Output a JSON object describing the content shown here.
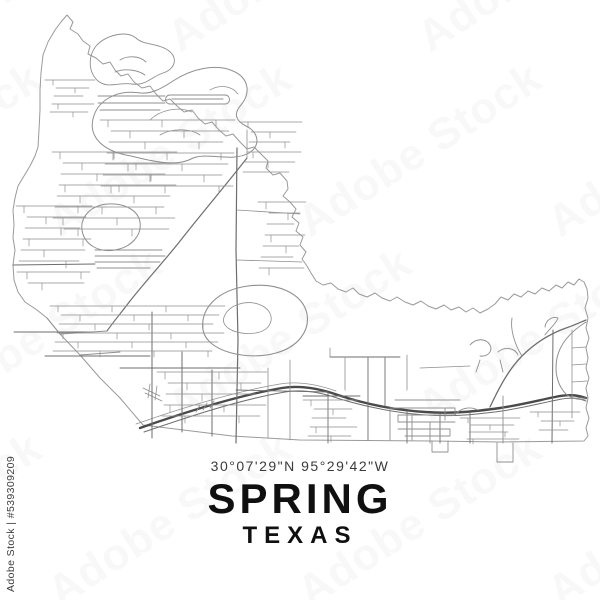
{
  "image": {
    "watermark_text": "Adobe Stock",
    "stock_id_label": "Adobe Stock | #539309209"
  },
  "title_block": {
    "coordinates": "30°07'29\"N 95°29'42\"W",
    "city": "SPRING",
    "state": "TEXAS",
    "text_color": "#101010",
    "coord_color": "#3b3b3b"
  },
  "map": {
    "background": "#ffffff",
    "boundary_color": "#9a9a9a",
    "minor_color": "#8f8f8f",
    "major_color": "#6e6e6e",
    "highway_color": "#4a4a4a",
    "paths": [
      {
        "d": "M67,15 L73,22 70,29 78,34 83,41 90,46 88,54 96,58 103,64 110,62 115,70 121,76 128,74 134,82 142,88 150,86 156,94 163,101 170,99 177,106 184,112 192,110 198,118 205,124 212,122 219,130 226,136 233,134 240,142 247,149 254,147 261,154 268,161 266,168 273,175 280,173 287,181 288,189 283,196 290,202 296,209 292,217 299,223 296,231 303,237 300,245 306,252 302,259 307,266 311,273 316,281 323,285 331,283 338,289 346,292 353,288 359,294 367,297 375,293 382,298 390,301 397,297 405,302 413,305 421,301 428,306 436,309 444,305 451,310 459,307 466,312 473,308 480,313 488,309 495,304 501,297 508,300 514,294 521,297 528,291 535,294 542,288 549,291 556,285 562,288 568,282 574,285 579,279 584,282 587,289 588,298 585,308 588,318 586,328 589,338 586,348 588,358 586,368 589,378 586,388 588,398 586,408 589,418 586,428 588,436 584,441 L500,442 432,441 300,440 232,436 143,425 120,398 100,378 80,355 60,334 47,318 37,310 25,302 18,292 14,280 13,265 15,250 13,238 14,225 13,210 15,198 18,186 24,176 30,166 35,156 38,147 39,130 40,110 40,90 41,73 43,55 48,42 55,30 61,22 Z",
        "w": 1,
        "c": "#9a9a9a"
      },
      {
        "d": "M140,428 C180,414 235,396 282,388 C300,385 318,388 338,395 C365,404 395,410 425,412 C455,414 478,411 500,408 C520,405 540,400 555,397 C568,394 577,395 586,398",
        "w": 2.4,
        "c": "#4a4a4a"
      },
      {
        "d": "M144,432 C185,418 238,400 285,392 C302,389 320,392 340,399 C367,407 396,413 426,415 C456,417 480,414 502,411 C522,408 542,403 557,400 C569,397 578,398 586,401",
        "w": 1,
        "c": "#6e6e6e"
      },
      {
        "d": "M136,424 C176,410 232,392 280,384 C298,381 316,384 336,391",
        "w": 0.8,
        "c": "#8f8f8f"
      },
      {
        "d": "M143,388 L160,396 M145,393 L162,401 M150,384 L148,398 M157,386 L155,400 M200,405 L196,412 M207,403 L203,410 M214,401 L210,408",
        "w": 0.8,
        "c": "#8f8f8f"
      },
      {
        "d": "M490,407 C498,390 508,370 522,356 C536,342 552,333 566,328 C575,325 581,322 586,320",
        "w": 1.3,
        "c": "#6e6e6e"
      },
      {
        "d": "M522,356 C515,345 510,330 512,318 M545,335 C550,328 556,324 558,318 C552,316 546,320 545,327",
        "w": 0.9,
        "c": "#8f8f8f"
      },
      {
        "d": "M586,322 C570,332 560,344 557,358 C554,373 558,386 566,394 C572,399 580,400 585,399",
        "w": 1,
        "c": "#8f8f8f"
      },
      {
        "d": "M572,330 L572,418 M572,348 L586,347 M572,365 L586,364 M572,382 L587,381 M572,398 L586,398",
        "w": 0.8,
        "c": "#8f8f8f"
      },
      {
        "d": "M553,330 L552,443",
        "w": 1,
        "c": "#6e6e6e"
      },
      {
        "d": "M237,148 L236,250 238,340 236,443",
        "w": 1.2,
        "c": "#6e6e6e"
      },
      {
        "d": "M152,312 L152,438 M182,352 L182,432 M212,370 L212,436",
        "w": 1,
        "c": "#6e6e6e"
      },
      {
        "d": "M268,368 L268,438 M290,360 L290,440",
        "w": 0.8,
        "c": "#8f8f8f"
      },
      {
        "d": "M328,392 L328,443 M368,358 L368,440 M385,358 L385,406 M407,412 L407,443 M440,414 L440,443 M470,413 L470,443",
        "w": 0.9,
        "c": "#6e6e6e"
      },
      {
        "d": "M503,396 L503,443 M497,443 L497,462 513,462 513,443 M432,441 L432,452 448,452 448,441",
        "w": 0.9,
        "c": "#8f8f8f"
      },
      {
        "d": "M45,356 L150,356 M14,332 L90,332 M13,265 L95,264 M120,368 L240,368 M330,357 L400,357 M236,390 L328,392 M303,396 L360,396",
        "w": 0.9,
        "c": "#6e6e6e"
      },
      {
        "d": "M247,158 C225,186 203,212 184,236 C168,257 149,277 130,301 C121,313 114,321 107,331",
        "w": 1.2,
        "c": "#6e6e6e"
      },
      {
        "d": "M237,210 L300,214 M237,260 L302,262 M247,158 L247,130",
        "w": 0.8,
        "c": "#8f8f8f"
      },
      {
        "d": "M98,96 L165,96 M98,103 L165,103 M100,110 L160,110 M170,95 L225,95 C231,95 231,104 225,104 L170,104 C164,104 164,95 170,95 Z M172,99 L223,99",
        "w": 0.9,
        "c": "#8f8f8f"
      },
      {
        "d": "M95,250 L162,250 M95,256 L165,256 M95,262 L160,262 M97,268 L150,268",
        "w": 0.9,
        "c": "#8f8f8f"
      },
      {
        "d": "M82,230 C80,216 92,205 108,204 C124,203 138,210 140,222 C142,235 132,247 115,250 C98,253 84,244 82,230 Z",
        "w": 1,
        "c": "#8f8f8f"
      },
      {
        "d": "M203,330 C200,308 218,290 248,286 C278,282 303,294 307,314 C310,331 298,347 276,353 C248,361 207,352 203,330 Z",
        "w": 1.1,
        "c": "#8f8f8f"
      },
      {
        "d": "M225,315 C230,305 245,300 258,304 C270,308 275,318 268,327 C260,336 238,335 228,328 C223,324 222,320 225,315 Z",
        "w": 0.8,
        "c": "#8f8f8f"
      },
      {
        "d": "M96,46 C106,35 126,30 136,38 C143,45 156,43 166,49 C179,56 176,69 163,73 C151,77 146,86 132,84 C118,82 108,89 98,81 C88,72 88,56 96,46 Z M120,60 C128,55 140,56 146,62 M115,72 C125,68 138,70 145,75",
        "w": 0.9,
        "c": "#8f8f8f"
      },
      {
        "d": "M131,156 C101,151 89,136 93,119 C97,101 116,89 141,93 C151,94 161,89 173,81 C191,69 216,63 233,71 C249,78 251,93 241,105 C233,114 236,121 246,126 C259,132 261,146 249,153 C231,163 206,151 191,159 C176,167 151,161 131,156 Z",
        "w": 1,
        "c": "#8f8f8f"
      },
      {
        "d": "M150,120 C160,110 178,106 192,112 M160,135 C172,128 190,128 200,135 M210,90 C220,84 232,86 238,94",
        "w": 0.8,
        "c": "#8f8f8f"
      },
      {
        "d": "M470,345 C476,338 486,338 490,345 C493,351 488,357 480,356 M498,352 C505,346 515,348 518,355 M480,360 L476,372 M500,360 L503,372 M455,415 C460,408 470,406 478,410",
        "w": 0.9,
        "c": "#8f8f8f"
      },
      {
        "d": "M390,408 L455,408 455,415 398,415 398,422 455,422 M390,408 L390,440 M398,429 L450,429 450,436 405,436 M412,415 L412,440 M430,422 L430,443 M445,408 L445,420 M395,400 L460,400",
        "w": 0.9,
        "c": "#8f8f8f"
      },
      {
        "d": "M330,348 L330,357 M345,357 L345,390 M407,355 L407,390 M420,368 L470,366",
        "w": 0.8,
        "c": "#8f8f8f"
      },
      {
        "d": "M60,334 L107,331 M47,318 L60,334 M80,355 L120,352",
        "w": 0.9,
        "c": "#8f8f8f"
      }
    ],
    "street_clusters": [
      {
        "x": 100,
        "y": 120,
        "w": 135,
        "h": 68,
        "gap": 11,
        "tooth": 7
      },
      {
        "x": 52,
        "y": 152,
        "w": 125,
        "h": 80,
        "gap": 11,
        "tooth": 7
      },
      {
        "x": 240,
        "y": 122,
        "w": 62,
        "h": 56,
        "gap": 10,
        "tooth": 6
      },
      {
        "x": 16,
        "y": 206,
        "w": 76,
        "h": 80,
        "gap": 11,
        "tooth": 7
      },
      {
        "x": 50,
        "y": 306,
        "w": 175,
        "h": 46,
        "gap": 9,
        "tooth": 6
      },
      {
        "x": 157,
        "y": 372,
        "w": 110,
        "h": 52,
        "gap": 11,
        "tooth": 7
      },
      {
        "x": 303,
        "y": 400,
        "w": 55,
        "h": 38,
        "gap": 9,
        "tooth": 6
      },
      {
        "x": 258,
        "y": 202,
        "w": 48,
        "h": 66,
        "gap": 11,
        "tooth": 7
      },
      {
        "x": 460,
        "y": 418,
        "w": 60,
        "h": 22,
        "gap": 7,
        "tooth": 5
      },
      {
        "x": 45,
        "y": 80,
        "w": 50,
        "h": 34,
        "gap": 8,
        "tooth": 5
      },
      {
        "x": 530,
        "y": 412,
        "w": 50,
        "h": 26,
        "gap": 9,
        "tooth": 5
      }
    ]
  }
}
